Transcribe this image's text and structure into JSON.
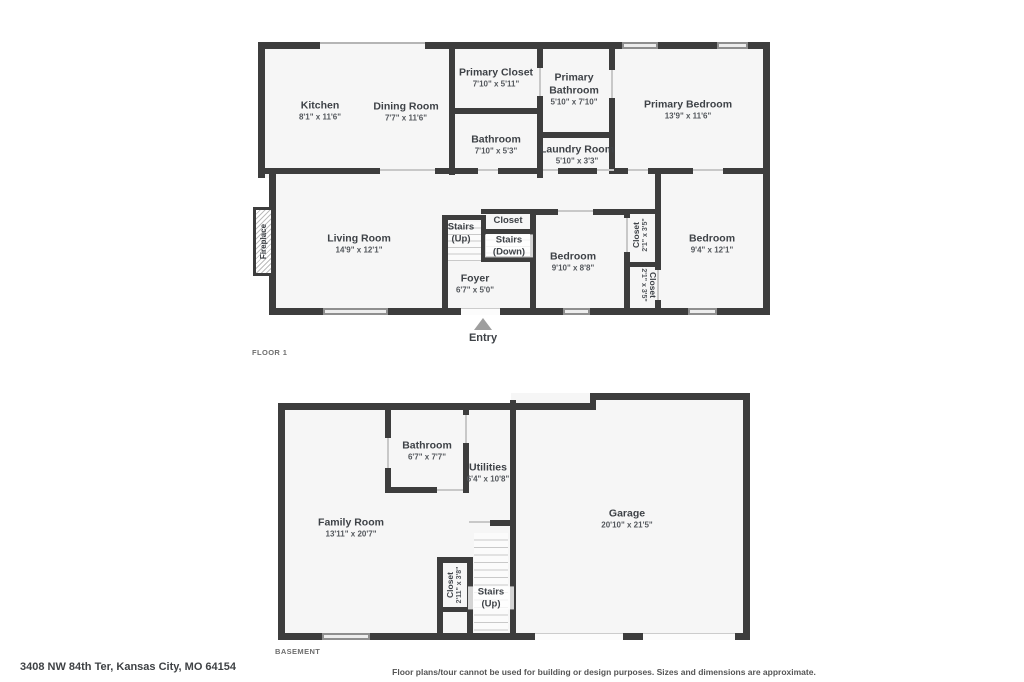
{
  "footer": {
    "address": "3408 NW 84th Ter, Kansas City, MO 64154",
    "disclaimer": "Floor plans/tour cannot be used for building or design purposes. Sizes and dimensions are approximate."
  },
  "colors": {
    "wall": "#3d3d3d",
    "floor_fill": "#f6f6f6",
    "window_fill": "#ededed",
    "window_frame": "#8f8f8f",
    "entry_arrow": "#9e9e9e",
    "label_text": "#3e4247"
  },
  "floor1": {
    "label": "FLOOR 1",
    "entry_label": "Entry",
    "fireplace_label": "Fireplace",
    "rooms": {
      "kitchen": {
        "name": "Kitchen",
        "dims": "8'1\" x 11'6\""
      },
      "dining_room": {
        "name": "Dining Room",
        "dims": "7'7\" x 11'6\""
      },
      "primary_closet": {
        "name": "Primary Closet",
        "dims": "7'10\" x 5'11\""
      },
      "primary_bathroom": {
        "name": "Primary Bathroom",
        "dims": "5'10\" x 7'10\""
      },
      "primary_bedroom": {
        "name": "Primary Bedroom",
        "dims": "13'9\" x 11'6\""
      },
      "bathroom": {
        "name": "Bathroom",
        "dims": "7'10\" x 5'3\""
      },
      "laundry_room": {
        "name": "Laundry Room",
        "dims": "5'10\" x 3'3\""
      },
      "living_room": {
        "name": "Living Room",
        "dims": "14'9\" x 12'1\""
      },
      "stairs_up": {
        "name": "Stairs (Up)"
      },
      "stair_closet": {
        "name": "Closet"
      },
      "stairs_down": {
        "name": "Stairs (Down)"
      },
      "foyer": {
        "name": "Foyer",
        "dims": "6'7\" x 5'0\""
      },
      "bedroom_1": {
        "name": "Bedroom",
        "dims": "9'10\" x 8'8\""
      },
      "closet_1": {
        "name": "Closet",
        "dims": "2'1\" x 3'5\""
      },
      "closet_2": {
        "name": "Closet",
        "dims": "2'1\" x 3'5\""
      },
      "bedroom_2": {
        "name": "Bedroom",
        "dims": "9'4\" x 12'1\""
      }
    }
  },
  "basement": {
    "label": "BASEMENT",
    "rooms": {
      "bathroom": {
        "name": "Bathroom",
        "dims": "6'7\" x 7'7\""
      },
      "utilities": {
        "name": "Utilities",
        "dims": "6'4\" x 10'8\""
      },
      "family_room": {
        "name": "Family Room",
        "dims": "13'11\" x 20'7\""
      },
      "garage": {
        "name": "Garage",
        "dims": "20'10\" x 21'5\""
      },
      "closet": {
        "name": "Closet",
        "dims": "2'11\" x 3'8\""
      },
      "stairs_up": {
        "name": "Stairs (Up)"
      }
    }
  }
}
